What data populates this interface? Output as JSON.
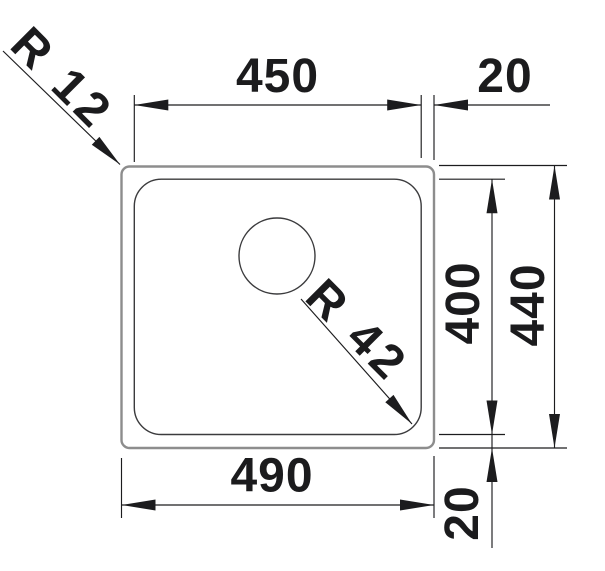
{
  "drawing": {
    "type": "technical-dimension-drawing",
    "subject": "sink-top-view",
    "colors": {
      "outer_contour": "#8d8d8d",
      "bowl_contour": "#3b3b3d",
      "dimension_lines": "#1c1c1e",
      "background": "#ffffff"
    },
    "top": {
      "bowl_width_label": "450",
      "rim_offset_label": "20"
    },
    "right": {
      "bowl_height_label": "400",
      "outer_height_label": "440"
    },
    "bottom": {
      "outer_width_label": "490",
      "rim_offset_label": "20"
    },
    "radii": {
      "outer_corner_label": "R 12",
      "bowl_corner_label": "R 42"
    }
  }
}
